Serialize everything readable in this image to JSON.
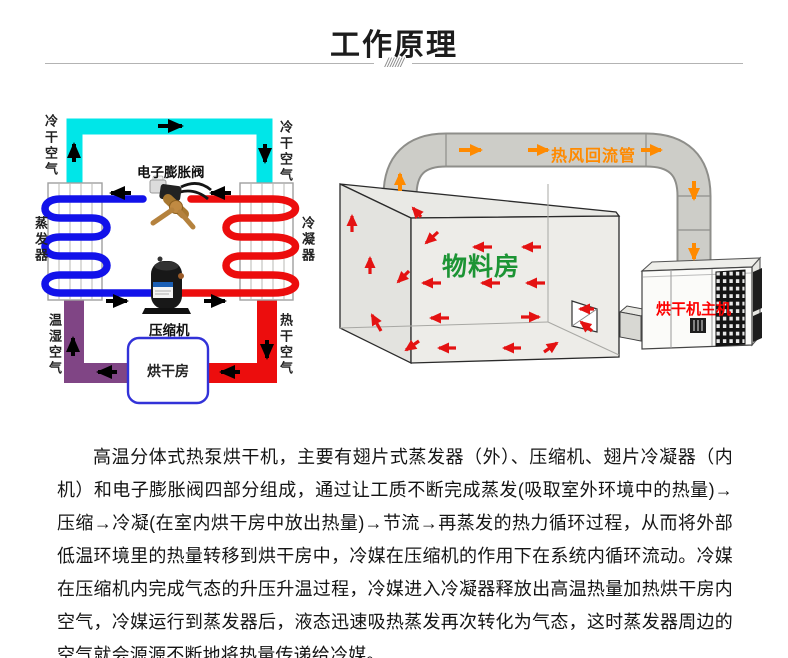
{
  "header": {
    "title": "工作原理",
    "divider_hatch": "///////"
  },
  "cycle_diagram": {
    "labels": {
      "cold_dry_air_left": "冷干空气",
      "cold_dry_air_right": "冷干空气",
      "evaporator": "蒸发器",
      "condenser": "冷凝器",
      "warm_humid_air": "温湿空气",
      "hot_dry_air": "热干空气",
      "expansion_valve": "电子膨胀阀",
      "compressor": "压缩机",
      "drying_room": "烘干房"
    },
    "colors": {
      "cold_dry_air_duct": "#00e6e8",
      "warm_humid_air_duct": "#804585",
      "hot_dry_air_duct": "#ec0d0d",
      "cold_refrigerant_pipe": "#1212ea",
      "hot_refrigerant_pipe": "#ec0d0d",
      "flow_arrow": "#000000",
      "drying_room_border": "#3232d8"
    }
  },
  "room_diagram": {
    "labels": {
      "return_duct": "热风回流管",
      "material_room": "物料房",
      "dryer_unit": "烘干机主机"
    },
    "colors": {
      "duct_gray": "#cdcdc8",
      "return_duct_label": "#ff8a00",
      "return_duct_arrow": "#ff8a00",
      "material_room_label": "#1c9434",
      "dryer_unit_label": "#fd0000",
      "airflow_arrow": "#e41212"
    }
  },
  "description": {
    "text": "高温分体式热泵烘干机，主要有翅片式蒸发器（外）、压缩机、翅片冷凝器（内机）和电子膨胀阀四部分组成，通过让工质不断完成蒸发(吸取室外环境中的热量)→压缩→冷凝(在室内烘干房中放出热量)→节流→再蒸发的热力循环过程，从而将外部低温环境里的热量转移到烘干房中，冷媒在压缩机的作用下在系统内循环流动。冷媒在压缩机内完成气态的升压升温过程，冷媒进入冷凝器释放出高温热量加热烘干房内空气，冷媒运行到蒸发器后，液态迅速吸热蒸发再次转化为气态，这时蒸发器周边的空气就会源源不断地将热量传递给冷媒。"
  }
}
